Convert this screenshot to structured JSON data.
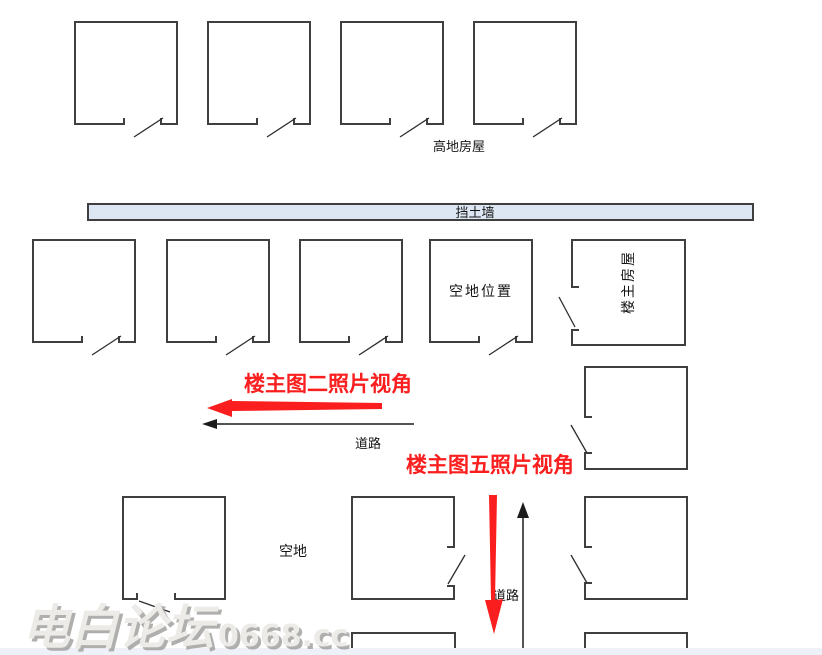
{
  "diagram": {
    "labels": {
      "highland_houses": "高地房屋",
      "retaining_wall": "挡土墙",
      "empty_lot_position": "空地位置",
      "owner_house": "楼主房屋",
      "road": "道路",
      "empty_lot": "空地",
      "photo2_view": "楼主图二照片视角",
      "photo5_view": "楼主图五照片视角"
    },
    "watermark": {
      "site_name": "电白论坛",
      "site_domain": "0668.cc"
    },
    "colors": {
      "annotation_red": "#fa1e1e",
      "wall_fill": "#dde6f3",
      "outline": "#3f3f3f",
      "watermark_fill": "#edebe7",
      "watermark_shadow": "#a2a2a0",
      "footer_strip": "#eef1f8"
    }
  }
}
